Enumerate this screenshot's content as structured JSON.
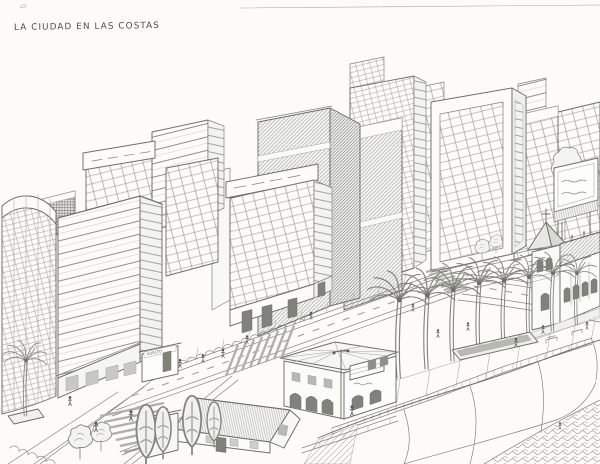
{
  "artwork": {
    "title": "La Ciudad en las Costas",
    "title_display": "LA CIUDAD EN LAS COSTAS"
  },
  "signs": {
    "kiosk": "VUELTO"
  },
  "colors": {
    "paper": "#fcfbf8",
    "pencil_dark": "#4e4e4a",
    "pencil": "#6e6e69",
    "pencil_mid": "#84847e",
    "pencil_light": "#a6a6a0",
    "shading": "#b9b9b3"
  },
  "scene": {
    "medium": "pencil sketch",
    "landmarks": [
      "high-rise skyline",
      "curved glass building",
      "concrete towers",
      "billboard with scribbled text",
      "church with bell tower and cross",
      "palm-lined coastal boulevard",
      "zebra crosswalks",
      "street kiosk",
      "colonial house with arcade and banner",
      "warehouse with corrugated roof",
      "cypress and round trees",
      "seaside promenade with railing and planter",
      "cliff coastline with scrub",
      "pedestrians"
    ]
  }
}
